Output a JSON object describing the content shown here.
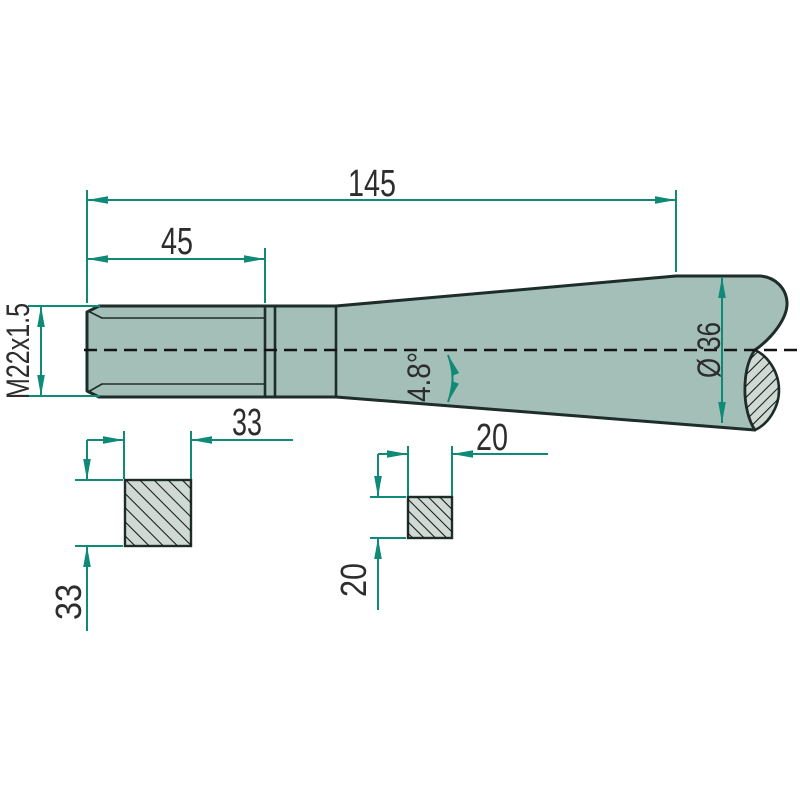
{
  "drawing": {
    "title": "tine technical drawing",
    "view": "side view with two square cross-sections",
    "dimensions": {
      "overall_length": "145",
      "thread_length": "45",
      "thread_spec": "M22x1.5",
      "taper_angle": "4.8°",
      "shaft_diameter": "Ø 36",
      "square_large_width": "33",
      "square_large_height": "33",
      "square_small_width": "20",
      "square_small_height": "20"
    },
    "colors": {
      "part_fill": "#a4bfb8",
      "section_fill": "#cfdad4",
      "outline_ink": "#1e2d2a",
      "dimension_green": "#0e8a76",
      "text_color": "#2d2d2d",
      "background": "#ffffff"
    }
  }
}
